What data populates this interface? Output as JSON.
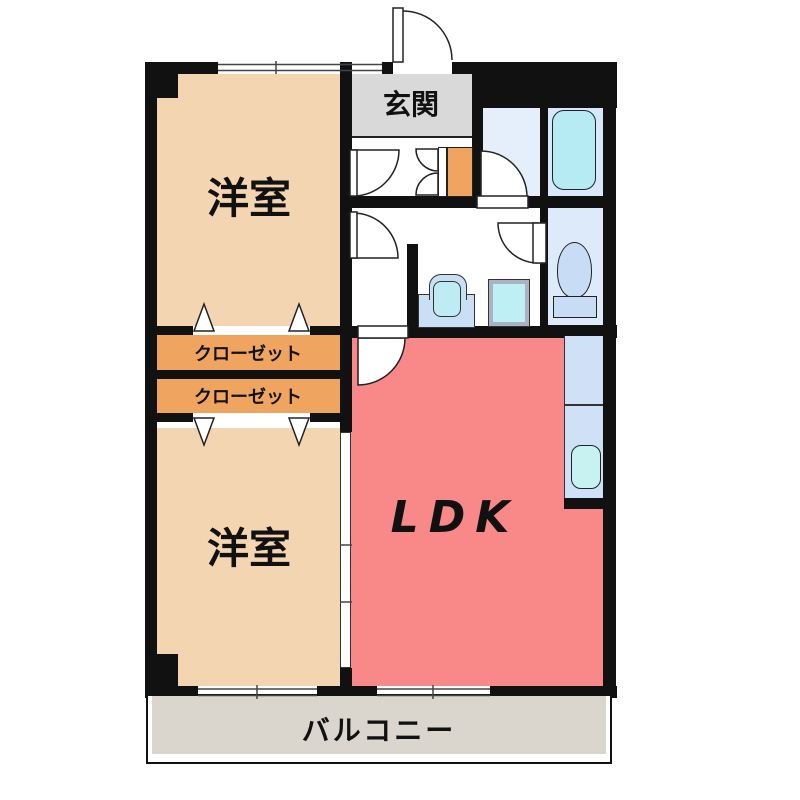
{
  "floor_plan": {
    "rooms": {
      "entrance": {
        "label": "玄関",
        "floor_color": "#d9d9d9"
      },
      "western_room_1": {
        "label": "洋室",
        "floor_color": "#f3d5b2"
      },
      "western_room_2": {
        "label": "洋室",
        "floor_color": "#f3d5b2"
      },
      "closet_1": {
        "label": "クローゼット",
        "floor_color": "#efa55f"
      },
      "closet_2": {
        "label": "クローゼット",
        "floor_color": "#efa55f"
      },
      "ldk": {
        "label": "LDK",
        "floor_color": "#f98989"
      },
      "balcony": {
        "label": "バルコニー",
        "floor_color": "#dad5cd"
      },
      "bathroom": {
        "floor_color": "#d7e8fa"
      },
      "toilet_room": {
        "floor_color": "#dceafa"
      },
      "washroom_vestibule": {
        "floor_color": "#e4effb"
      }
    },
    "fixtures": [
      "bathtub",
      "toilet",
      "washbasin",
      "washing-machine-pan",
      "kitchen-counter",
      "kitchen-sink",
      "shoe-cabinet"
    ],
    "colors": {
      "wall": "#111111",
      "fixture_cyan": "#b7ebf4",
      "fixture_blue": "#c9dcf5",
      "counter_blue": "#cee1f7",
      "sink_cyan": "#c8f2f2"
    }
  }
}
